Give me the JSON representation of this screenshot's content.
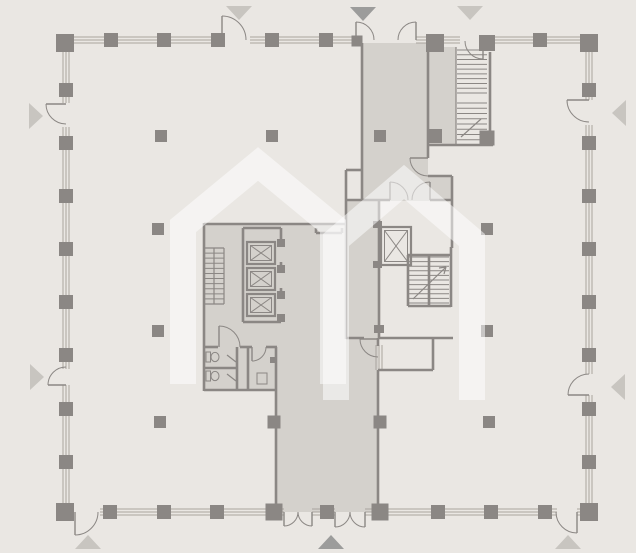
{
  "canvas": {
    "w": 636,
    "h": 553
  },
  "colors": {
    "bg": "#eae7e3",
    "fill": "#d4d1cc",
    "wall": "#8b8784",
    "mullion": "#a9a49e",
    "tri_light": "#c8c5c0",
    "tri_dark": "#9c9c9b",
    "watermark": "rgba(255,255,255,0.52)"
  },
  "watermark": {
    "icon": "double-house-logo",
    "stroke_width": 26,
    "paths": [
      "M183 384 L183 226 L258 164 L333 226 L333 384",
      "M336 400 L336 240 L404 182 L472 240 L472 400"
    ]
  },
  "fills": [
    {
      "n": "core-lobby-fill",
      "x": 204,
      "y": 224,
      "w": 142,
      "h": 166
    },
    {
      "n": "right-core-vestibule-fill",
      "x": 346,
      "y": 200,
      "w": 33,
      "h": 138
    },
    {
      "n": "top-corridor-fill",
      "x": 362,
      "y": 43,
      "w": 66,
      "h": 158
    },
    {
      "n": "top-corridor-nook-fill",
      "x": 428,
      "y": 176,
      "w": 24,
      "h": 25
    },
    {
      "n": "ne-stair-vestibule-fill",
      "x": 428,
      "y": 47,
      "w": 28,
      "h": 98
    },
    {
      "n": "bottom-corridor-fill",
      "x": 276,
      "y": 338,
      "w": 102,
      "h": 174
    }
  ],
  "curtain_walls": [
    {
      "o": "h",
      "a": 40,
      "segs": [
        [
          65,
          222
        ],
        [
          250,
          356
        ],
        [
          416,
          460
        ],
        [
          483,
          585
        ]
      ]
    },
    {
      "o": "h",
      "a": 512,
      "segs": [
        [
          100,
          284
        ],
        [
          312,
          335
        ],
        [
          365,
          557
        ],
        [
          577,
          585
        ]
      ]
    },
    {
      "o": "v",
      "a": 66,
      "segs": [
        [
          52,
          103
        ],
        [
          127,
          369
        ],
        [
          385,
          504
        ]
      ]
    },
    {
      "o": "v",
      "a": 589,
      "segs": [
        [
          52,
          100
        ],
        [
          125,
          374
        ],
        [
          395,
          504
        ]
      ]
    },
    {
      "o": "v",
      "a": 379,
      "segs": [
        [
          345,
          370
        ]
      ]
    }
  ],
  "walls": [
    [
      204,
      224,
      346,
      224
    ],
    [
      204,
      223,
      204,
      391
    ],
    [
      346,
      170,
      346,
      339
    ],
    [
      346,
      170,
      362,
      170
    ],
    [
      204,
      390,
      277,
      390
    ],
    [
      276,
      347,
      276,
      513
    ],
    [
      204,
      347,
      218,
      347
    ],
    [
      240,
      347,
      252,
      347
    ],
    [
      266,
      347,
      277,
      347
    ],
    [
      204,
      368,
      237,
      368
    ],
    [
      237,
      347,
      237,
      390
    ],
    [
      248,
      347,
      248,
      390
    ],
    [
      243,
      228,
      243,
      322
    ],
    [
      243,
      228,
      281,
      228
    ],
    [
      243,
      322,
      281,
      322
    ],
    [
      281,
      228,
      281,
      246
    ],
    [
      281,
      262,
      281,
      272
    ],
    [
      281,
      288,
      281,
      298
    ],
    [
      281,
      314,
      281,
      322
    ],
    [
      362,
      43,
      362,
      201
    ],
    [
      428,
      43,
      428,
      158
    ],
    [
      428,
      176,
      452,
      176
    ],
    [
      452,
      176,
      452,
      248
    ],
    [
      346,
      200,
      390,
      200
    ],
    [
      430,
      200,
      452,
      200
    ],
    [
      379,
      200,
      379,
      339
    ],
    [
      428,
      145,
      493,
      145
    ],
    [
      490,
      52,
      490,
      131
    ],
    [
      408,
      255,
      450,
      255
    ],
    [
      408,
      255,
      408,
      306
    ],
    [
      408,
      306,
      451,
      306
    ],
    [
      451,
      247,
      451,
      307
    ],
    [
      429,
      255,
      429,
      306
    ],
    [
      346,
      338,
      364,
      338
    ],
    [
      379,
      338,
      453,
      338
    ],
    [
      433,
      338,
      433,
      370
    ],
    [
      378,
      370,
      433,
      370
    ],
    [
      378,
      338,
      378,
      346
    ],
    [
      378,
      370,
      378,
      513
    ],
    [
      316,
      233,
      342,
      233
    ],
    [
      316,
      228,
      316,
      233
    ],
    [
      342,
      228,
      342,
      233
    ]
  ],
  "thin_lines": [
    [
      204,
      248,
      224,
      248
    ],
    [
      204,
      304,
      224,
      304
    ],
    [
      224,
      248,
      224,
      304
    ],
    [
      214,
      248,
      214,
      304
    ],
    [
      456,
      47,
      456,
      145
    ],
    [
      227,
      355,
      236,
      362
    ],
    [
      227,
      374,
      236,
      381
    ],
    [
      461,
      137,
      481,
      119
    ],
    [
      413,
      299,
      446,
      267
    ],
    [
      446,
      267,
      439,
      268
    ],
    [
      446,
      267,
      444,
      274
    ]
  ],
  "stairs": [
    {
      "n": "core-stair",
      "x": 204,
      "y": 248,
      "w": 20,
      "h": 56,
      "treads": 11
    },
    {
      "n": "ne-stair-upper-run",
      "x": 457,
      "y": 50,
      "w": 30,
      "h": 43,
      "treads": 9
    },
    {
      "n": "ne-stair-lower-run",
      "x": 457,
      "y": 103,
      "w": 30,
      "h": 42,
      "treads": 8
    },
    {
      "n": "right-core-stair-left-run",
      "x": 409,
      "y": 257,
      "w": 19,
      "h": 46,
      "treads": 10
    },
    {
      "n": "right-core-stair-right-run",
      "x": 430,
      "y": 257,
      "w": 19,
      "h": 46,
      "treads": 10
    }
  ],
  "elevators": [
    {
      "n": "elevator-shaft-1",
      "x": 247,
      "y": 242,
      "w": 28,
      "h": 22
    },
    {
      "n": "elevator-shaft-2",
      "x": 247,
      "y": 268,
      "w": 28,
      "h": 22
    },
    {
      "n": "elevator-shaft-3",
      "x": 247,
      "y": 294,
      "w": 28,
      "h": 22
    },
    {
      "n": "elevator-shaft-4",
      "x": 381,
      "y": 227,
      "w": 30,
      "h": 38
    }
  ],
  "stub_rects": [
    [
      277,
      239,
      8,
      8
    ],
    [
      277,
      265,
      8,
      8
    ],
    [
      277,
      291,
      8,
      8
    ],
    [
      277,
      314,
      8,
      8
    ],
    [
      373,
      221,
      9,
      7
    ],
    [
      373,
      261,
      9,
      7
    ],
    [
      374,
      325,
      10,
      8
    ],
    [
      270,
      357,
      6,
      6
    ]
  ],
  "fixtures": [
    {
      "n": "sink-fixture",
      "x": 257,
      "y": 373,
      "w": 10,
      "h": 11
    }
  ],
  "toilets": [
    {
      "x": 206,
      "y": 352
    },
    {
      "x": 206,
      "y": 371
    }
  ],
  "doors": [
    {
      "h": [
        222,
        40
      ],
      "l": [
        222,
        16
      ],
      "e": [
        246,
        40
      ],
      "s": 1
    },
    {
      "h": [
        356,
        40
      ],
      "l": [
        356,
        22
      ],
      "e": [
        374,
        40
      ],
      "s": 1
    },
    {
      "h": [
        416,
        40
      ],
      "l": [
        416,
        22
      ],
      "e": [
        398,
        40
      ],
      "s": 0
    },
    {
      "h": [
        483,
        41
      ],
      "l": [
        483,
        59
      ],
      "e": [
        465,
        41
      ],
      "s": 1
    },
    {
      "h": [
        66,
        104
      ],
      "l": [
        46,
        104
      ],
      "e": [
        66,
        124
      ],
      "s": 0
    },
    {
      "h": [
        66,
        385
      ],
      "l": [
        48,
        385
      ],
      "e": [
        66,
        367
      ],
      "s": 1
    },
    {
      "h": [
        589,
        100
      ],
      "l": [
        567,
        100
      ],
      "e": [
        589,
        122
      ],
      "s": 0
    },
    {
      "h": [
        589,
        395
      ],
      "l": [
        568,
        395
      ],
      "e": [
        589,
        374
      ],
      "s": 1
    },
    {
      "h": [
        75,
        512
      ],
      "l": [
        75,
        535
      ],
      "e": [
        98,
        512
      ],
      "s": 0
    },
    {
      "h": [
        577,
        512
      ],
      "l": [
        577,
        533
      ],
      "e": [
        556,
        512
      ],
      "s": 1
    },
    {
      "h": [
        284,
        512
      ],
      "l": [
        284,
        526
      ],
      "e": [
        298,
        512
      ],
      "s": 0
    },
    {
      "h": [
        312,
        512
      ],
      "l": [
        312,
        526
      ],
      "e": [
        298,
        512
      ],
      "s": 1
    },
    {
      "h": [
        335,
        512
      ],
      "l": [
        335,
        527
      ],
      "e": [
        350,
        512
      ],
      "s": 0
    },
    {
      "h": [
        365,
        512
      ],
      "l": [
        365,
        527
      ],
      "e": [
        350,
        512
      ],
      "s": 1
    },
    {
      "h": [
        219,
        347
      ],
      "l": [
        219,
        326
      ],
      "e": [
        240,
        347
      ],
      "s": 1
    },
    {
      "h": [
        252,
        347
      ],
      "l": [
        252,
        361
      ],
      "e": [
        266,
        347
      ],
      "s": 0
    },
    {
      "h": [
        378,
        339
      ],
      "l": [
        360,
        339
      ],
      "e": [
        378,
        357
      ],
      "s": 0
    },
    {
      "h": [
        428,
        158
      ],
      "l": [
        410,
        158
      ],
      "e": [
        428,
        176
      ],
      "s": 0
    },
    {
      "h": [
        390,
        200
      ],
      "l": [
        390,
        182
      ],
      "e": [
        408,
        200
      ],
      "s": 1
    },
    {
      "h": [
        430,
        200
      ],
      "l": [
        430,
        182
      ],
      "e": [
        412,
        200
      ],
      "s": 0
    }
  ],
  "columns": [
    [
      65,
      43,
      18
    ],
    [
      589,
      43,
      18
    ],
    [
      65,
      512,
      18
    ],
    [
      589,
      512,
      18
    ],
    [
      111,
      40,
      14
    ],
    [
      164,
      40,
      14
    ],
    [
      218,
      40,
      14
    ],
    [
      272,
      40,
      14
    ],
    [
      326,
      40,
      14
    ],
    [
      540,
      40,
      14
    ],
    [
      357,
      41,
      11
    ],
    [
      435,
      43,
      18
    ],
    [
      487,
      43,
      16
    ],
    [
      110,
      512,
      14
    ],
    [
      164,
      512,
      14
    ],
    [
      217,
      512,
      14
    ],
    [
      327,
      512,
      14
    ],
    [
      438,
      512,
      14
    ],
    [
      491,
      512,
      14
    ],
    [
      545,
      512,
      14
    ],
    [
      274,
      512,
      17
    ],
    [
      380,
      512,
      17
    ],
    [
      66,
      90,
      14
    ],
    [
      66,
      143,
      14
    ],
    [
      66,
      196,
      14
    ],
    [
      66,
      249,
      14
    ],
    [
      66,
      302,
      14
    ],
    [
      66,
      355,
      14
    ],
    [
      66,
      409,
      14
    ],
    [
      66,
      462,
      14
    ],
    [
      589,
      90,
      14
    ],
    [
      589,
      143,
      14
    ],
    [
      589,
      196,
      14
    ],
    [
      589,
      249,
      14
    ],
    [
      589,
      302,
      14
    ],
    [
      589,
      355,
      14
    ],
    [
      589,
      409,
      14
    ],
    [
      589,
      462,
      14
    ],
    [
      487,
      138,
      15
    ],
    [
      161,
      136,
      12
    ],
    [
      272,
      136,
      12
    ],
    [
      380,
      136,
      12
    ],
    [
      435,
      136,
      14
    ],
    [
      158,
      229,
      12
    ],
    [
      487,
      229,
      12
    ],
    [
      158,
      331,
      12
    ],
    [
      487,
      331,
      12
    ],
    [
      160,
      422,
      12
    ],
    [
      489,
      422,
      12
    ],
    [
      274,
      422,
      13
    ],
    [
      380,
      422,
      13
    ]
  ],
  "triangles": [
    {
      "x": 239,
      "y": 12,
      "dir": "down",
      "c": "light"
    },
    {
      "x": 363,
      "y": 13,
      "dir": "down",
      "c": "dark"
    },
    {
      "x": 470,
      "y": 12,
      "dir": "down",
      "c": "light"
    },
    {
      "x": 35,
      "y": 116,
      "dir": "right",
      "c": "light"
    },
    {
      "x": 36,
      "y": 377,
      "dir": "right",
      "c": "light"
    },
    {
      "x": 620,
      "y": 113,
      "dir": "left",
      "c": "light"
    },
    {
      "x": 619,
      "y": 387,
      "dir": "left",
      "c": "light"
    },
    {
      "x": 88,
      "y": 543,
      "dir": "up",
      "c": "light"
    },
    {
      "x": 331,
      "y": 543,
      "dir": "up",
      "c": "dark"
    },
    {
      "x": 568,
      "y": 543,
      "dir": "up",
      "c": "light"
    }
  ]
}
